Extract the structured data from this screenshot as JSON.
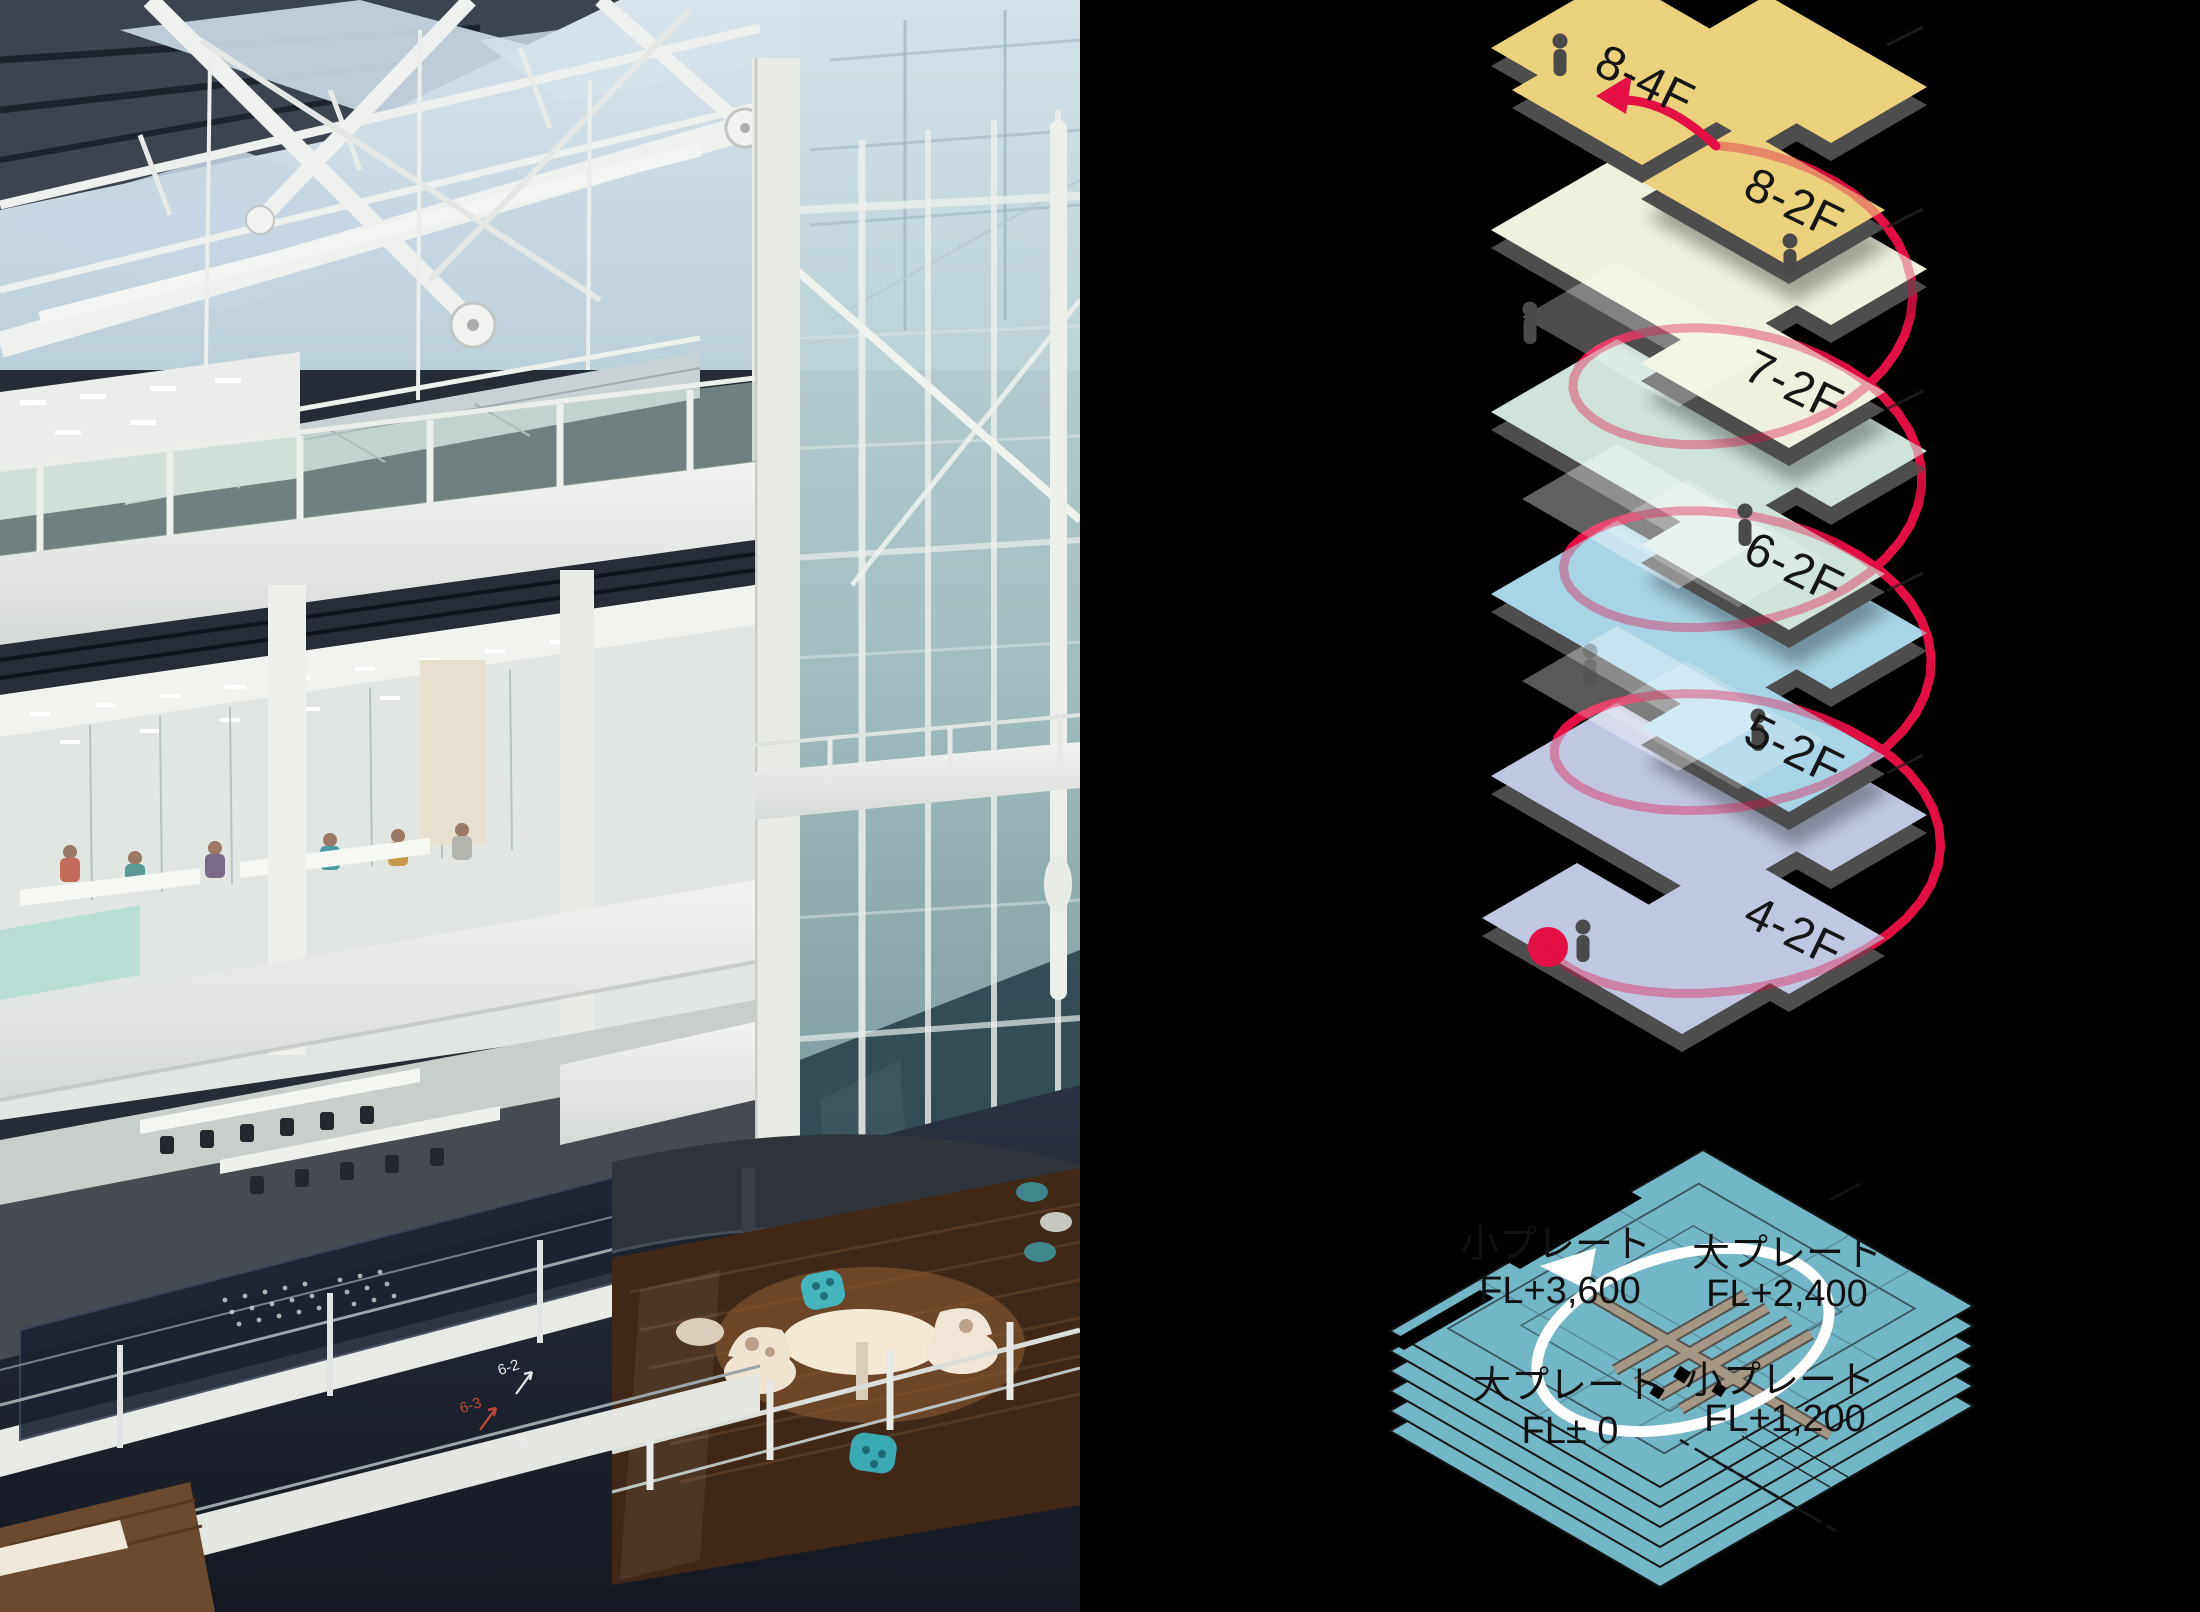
{
  "page": {
    "background": "#000000"
  },
  "photo": {
    "floor_markings": {
      "m1": "6-2",
      "m2": "6-3",
      "m3": "4"
    }
  },
  "exploded_diagram": {
    "route_color": "#e30f45",
    "slab_color": "#4d4d4d",
    "floors": {
      "f84": {
        "label": "8-4F",
        "color": "#ecd17c"
      },
      "f82": {
        "label": "8-2F",
        "color": "#ecd17c"
      },
      "f72": {
        "label": "7-2F",
        "color": "#eef1dd"
      },
      "f62": {
        "label": "6-2F",
        "color": "#cfe3da"
      },
      "f52": {
        "label": "5-2F",
        "color": "#a7d4e6"
      },
      "f42": {
        "label": "4-2F",
        "color": "#c0c7e1"
      }
    }
  },
  "plate_diagram": {
    "plate_color": "#73b6c7",
    "circle_color": "#ffffff",
    "lattice_color": "#a59786",
    "labels": {
      "tl": {
        "name": "小プレート",
        "level": "FL+3,600"
      },
      "tr": {
        "name": "大プレート",
        "level": "FL+2,400"
      },
      "bl": {
        "name": "大プレート",
        "level": "FL± 0"
      },
      "br": {
        "name": "小プレート",
        "level": "FL+1,200"
      }
    }
  }
}
